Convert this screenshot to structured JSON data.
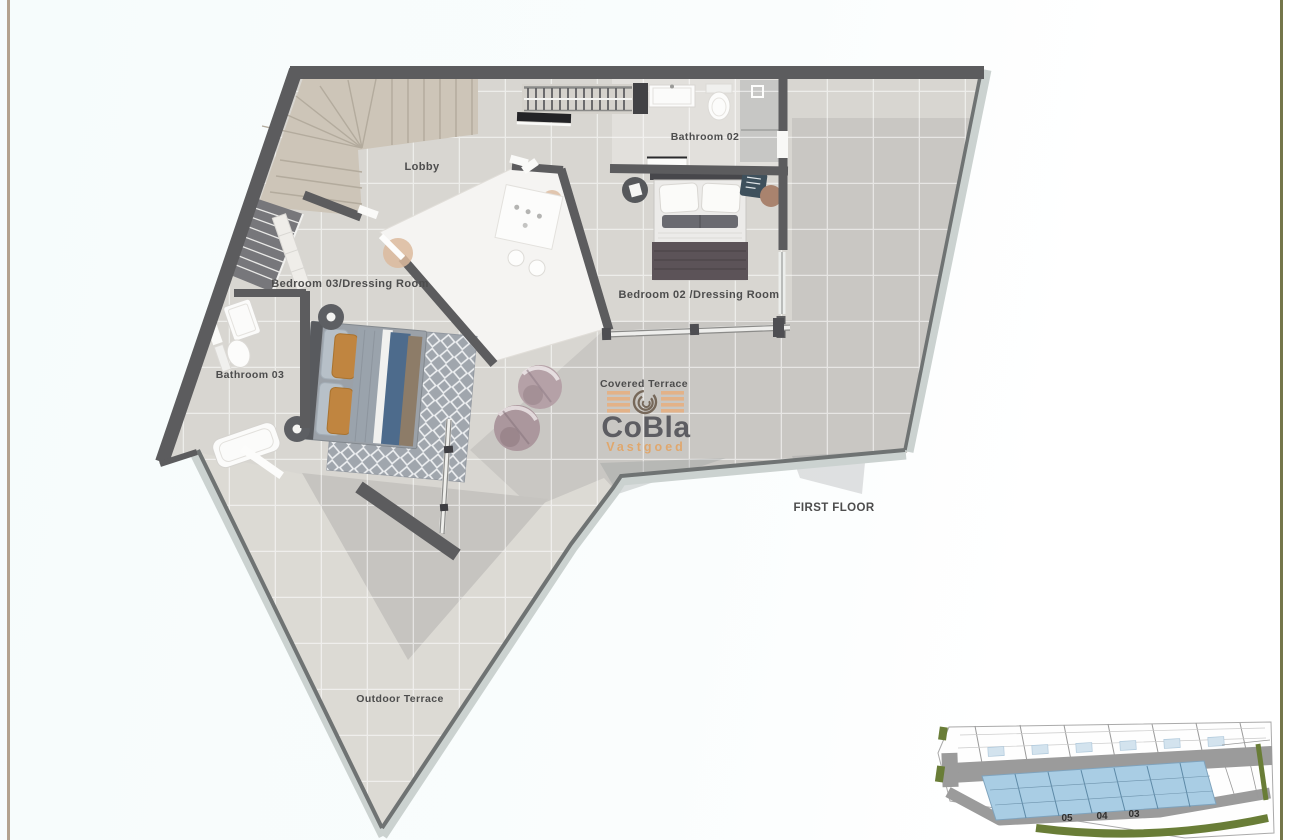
{
  "page": {
    "background_left": "#f6fcfc",
    "background_right": "#ffffff",
    "border_left_color": "#b3a28e",
    "border_right_color": "#74764a"
  },
  "plan": {
    "floor_label": "FIRST FLOOR",
    "labels": {
      "lobby": "Lobby",
      "bathroom_02": "Bathroom 02",
      "bedroom_02": "Bedroom 02 /Dressing Room",
      "bedroom_03": "Bedroom 03/Dressing Room",
      "bathroom_03": "Bathroom 03",
      "covered_terrace": "Covered Terrace",
      "outdoor_terrace": "Outdoor Terrace"
    },
    "colors": {
      "wall": "#5c5c5e",
      "floor": "#d8d6d1",
      "terrace_floor": "#c9c7c3",
      "outdoor_floor": "#dcdad4",
      "glass_band": "#cbd2d0",
      "label_text": "#4d4d4d",
      "void_white": "#f5f4f2",
      "stair_beige": "#cdc5b8"
    }
  },
  "logo": {
    "name": "CoBla",
    "tagline": "Vastgoed",
    "name_color": "#54555a",
    "tagline_color": "#e2a566",
    "bar_color": "#e6b183"
  },
  "site_plan": {
    "highlighted_units": [
      "05",
      "04",
      "03"
    ],
    "highlight_color": "#a9cde4",
    "road_color": "#9b9b9b",
    "green_color": "#697d37"
  }
}
